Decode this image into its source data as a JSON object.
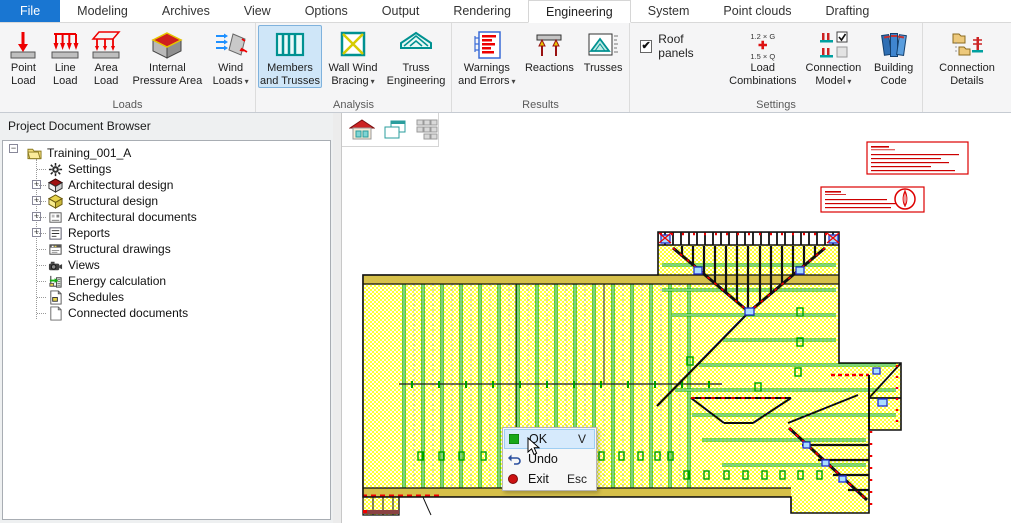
{
  "ui": {
    "dropdown_glyph": "▾",
    "check_glyph": "✔",
    "expander_collapsed": "+",
    "expander_expanded": "−"
  },
  "tabs": [
    {
      "label": "File"
    },
    {
      "label": "Modeling"
    },
    {
      "label": "Archives"
    },
    {
      "label": "View"
    },
    {
      "label": "Options"
    },
    {
      "label": "Output"
    },
    {
      "label": "Rendering"
    },
    {
      "label": "Engineering"
    },
    {
      "label": "System"
    },
    {
      "label": "Point clouds"
    },
    {
      "label": "Drafting"
    }
  ],
  "active_tab": "Engineering",
  "ribbon": {
    "groups": [
      {
        "label": "Loads",
        "buttons": [
          {
            "label": "Point Load",
            "icon": "point-load-icon"
          },
          {
            "label": "Line Load",
            "icon": "line-load-icon"
          },
          {
            "label": "Area Load",
            "icon": "area-load-icon"
          },
          {
            "label": "Internal Pressure Area",
            "icon": "internal-pressure-area-icon"
          },
          {
            "label": "Wind Loads",
            "icon": "wind-loads-icon",
            "has_dropdown": true
          }
        ]
      },
      {
        "label": "Analysis",
        "buttons": [
          {
            "label": "Members and Trusses",
            "icon": "members-and-trusses-icon",
            "selected": true
          },
          {
            "label": "Wall Wind Bracing",
            "icon": "wall-wind-bracing-icon",
            "has_dropdown": true
          },
          {
            "label": "Truss Engineering",
            "icon": "truss-engineering-icon"
          }
        ]
      },
      {
        "label": "Results",
        "buttons": [
          {
            "label": "Warnings and Errors",
            "icon": "warnings-and-errors-icon",
            "has_dropdown": true
          },
          {
            "label": "Reactions",
            "icon": "reactions-icon"
          },
          {
            "label": "Trusses",
            "icon": "trusses-icon"
          }
        ]
      },
      {
        "label": "Settings",
        "checkbox": {
          "label": "Roof panels",
          "checked": true
        },
        "buttons": [
          {
            "label": "Load Combinations",
            "icon": "load-combinations-icon",
            "icon_lines": [
              "1.2 × G",
              "✚",
              "1.5 × Q"
            ]
          },
          {
            "label": "Connection Model",
            "icon": "connection-model-icon",
            "has_dropdown": true
          },
          {
            "label": "Building Code",
            "icon": "building-code-icon"
          }
        ]
      },
      {
        "label": "",
        "buttons": [
          {
            "label": "Connection Details",
            "icon": "connection-details-icon"
          }
        ]
      }
    ]
  },
  "sidebar": {
    "title": "Project Document Browser",
    "tree": {
      "root": {
        "label": "Training_001_A"
      },
      "items": [
        {
          "label": "Settings",
          "expandable": false
        },
        {
          "label": "Architectural design",
          "expandable": true
        },
        {
          "label": "Structural design",
          "expandable": true
        },
        {
          "label": "Architectural documents",
          "expandable": true
        },
        {
          "label": "Reports",
          "expandable": true
        },
        {
          "label": "Structural drawings",
          "expandable": false
        },
        {
          "label": "Views",
          "expandable": false
        },
        {
          "label": "Energy calculation",
          "expandable": false
        },
        {
          "label": "Schedules",
          "expandable": false
        },
        {
          "label": "Connected documents",
          "expandable": false
        }
      ]
    }
  },
  "canvas": {
    "toolbar": [
      {
        "icon": "model-home-view-icon"
      },
      {
        "icon": "cascade-windows-icon"
      },
      {
        "icon": "tile-windows-icon"
      }
    ],
    "drawing": "roof framing plan with yellow panel hatch, green truss lines and red annotation boxes"
  },
  "context_menu": {
    "items": [
      {
        "label": "OK",
        "shortcut": "V",
        "icon": "ok-icon",
        "highlighted": true
      },
      {
        "label": "Undo",
        "shortcut": "",
        "icon": "undo-icon",
        "highlighted": false
      },
      {
        "label": "Exit",
        "shortcut": "Esc",
        "icon": "exit-icon",
        "highlighted": false
      }
    ]
  },
  "colors": {
    "accent_blue": "#1976d2",
    "ribbon_selection": "#cfe6f8",
    "plan_green": "#00a800",
    "plan_yellow": "#ffff33",
    "plan_red": "#ee0000",
    "plan_brown": "#8a4343",
    "annotation_red": "#dd0000",
    "menu_highlight": "#d6eafc",
    "teal_icon": "#009191"
  }
}
